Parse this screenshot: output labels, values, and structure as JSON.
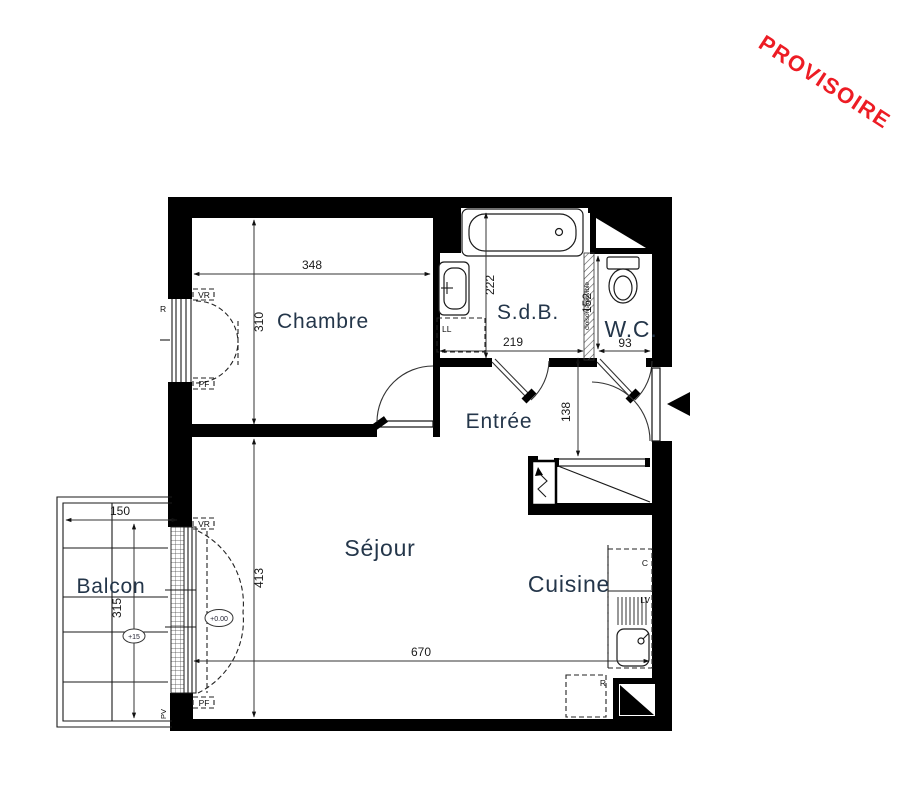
{
  "stamp": {
    "text": "PROVISOIRE",
    "color": "#ed1c24"
  },
  "rooms": {
    "chambre": "Chambre",
    "sdb": "S.d.B.",
    "wc": "W.C.",
    "entree": "Entrée",
    "sejour": "Séjour",
    "cuisine": "Cuisine",
    "balcon": "Balcon"
  },
  "dimensions": {
    "chambre_width": "348",
    "chambre_height": "310",
    "sdb_height": "222",
    "sdb_width": "219",
    "wc_height": "152",
    "wc_width": "93",
    "entree_height": "138",
    "sejour_height": "413",
    "sejour_width": "670",
    "balcon_width": "150",
    "balcon_height": "315"
  },
  "levels": {
    "sejour": "+0.00",
    "balcon": "+15"
  },
  "tags": {
    "window_top": "VR",
    "window_bottom": "PF",
    "washing_machine": "LL",
    "dishwasher": "LV",
    "cooker": "C",
    "fridge": "R",
    "radiator": "R",
    "door_type": "PV",
    "partition": "cloison amovible"
  }
}
